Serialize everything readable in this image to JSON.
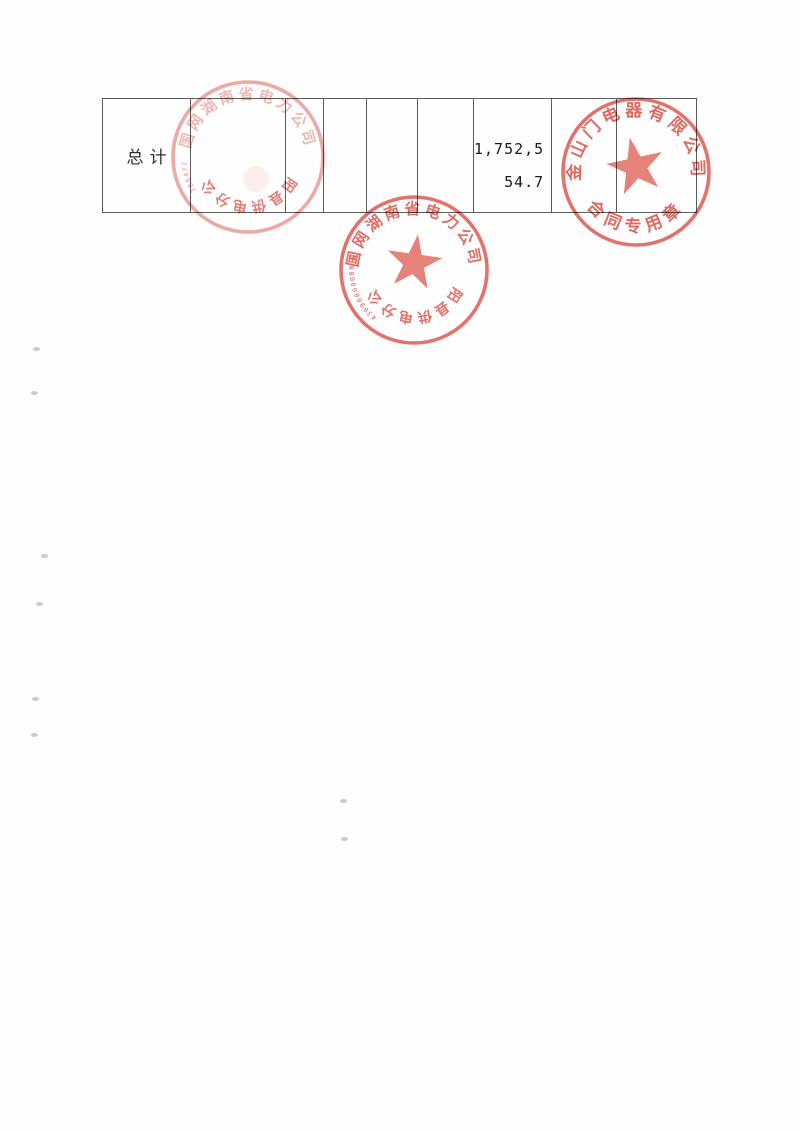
{
  "table": {
    "row": {
      "label": "总计",
      "amount_line1": "1,752,5",
      "amount_line2": "54.7",
      "amount_full": "1,752,554.7"
    }
  },
  "seal_colors": {
    "ring": "#e0645c",
    "text": "#dc5a52",
    "star": "#e4786e"
  },
  "stamps": [
    {
      "name": "power-company-seal-upper",
      "cx": 248,
      "cy": 157,
      "r": 75,
      "top_text": "国网湖南省电力公司",
      "bottom_text": "桂阳县供电分公司",
      "bottom_upside_down": true,
      "serial": "380472",
      "has_star": false,
      "star_size": 0,
      "star_rotate": 0,
      "star_dy": 0,
      "ring_opacity": 0.55,
      "top_opacity": 0.42,
      "bottom_opacity": 0.78,
      "top_font": 15,
      "bottom_font": 14,
      "top_spacing": 3.5,
      "bottom_spacing": 3
    },
    {
      "name": "power-company-seal-lower",
      "cx": 414,
      "cy": 270,
      "r": 73,
      "top_text": "国网湖南省电力公司",
      "bottom_text": "桂阳县供电分公司",
      "bottom_upside_down": true,
      "serial": "4309000000813",
      "has_star": true,
      "star_size": 29,
      "star_rotate": 8,
      "star_dy": -7,
      "ring_opacity": 0.9,
      "top_opacity": 0.88,
      "bottom_opacity": 0.85,
      "top_font": 15.5,
      "bottom_font": 14,
      "top_spacing": 3.5,
      "bottom_spacing": 3
    },
    {
      "name": "supplier-contract-seal",
      "cx": 636,
      "cy": 172,
      "r": 73,
      "top_text": "金山门电器有限公司",
      "bottom_text": "合同专用章",
      "bottom_upside_down": false,
      "serial": "",
      "has_star": true,
      "star_size": 30,
      "star_rotate": -12,
      "star_dy": -5,
      "ring_opacity": 0.9,
      "top_opacity": 0.9,
      "bottom_opacity": 0.9,
      "top_font": 17,
      "bottom_font": 17,
      "top_spacing": 4.5,
      "bottom_spacing": 6
    }
  ],
  "artifacts": {
    "specks": [
      [
        33,
        347
      ],
      [
        31,
        391
      ],
      [
        41,
        554
      ],
      [
        36,
        602
      ],
      [
        32,
        697
      ],
      [
        31,
        733
      ],
      [
        340,
        799
      ],
      [
        341,
        837
      ]
    ]
  }
}
